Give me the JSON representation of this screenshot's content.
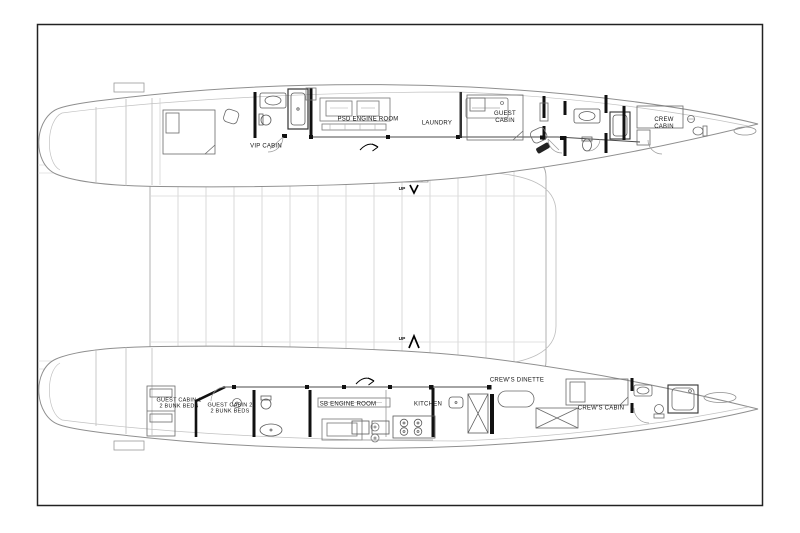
{
  "plan": {
    "port_hull": {
      "vip_cabin_label": "VIP CABIN",
      "engine_room_label": "PSD ENGINE ROOM",
      "laundry_label": "LAUNDRY",
      "guest_cabin_label_line1": "GUEST",
      "guest_cabin_label_line2": "CABIN",
      "crew_cabin_label_line1": "CREW",
      "crew_cabin_label_line2": "CABIN"
    },
    "starboard_hull": {
      "guest_cabin_1_label": "GUEST CABIN 1",
      "guest_cabin_1_sub": "2 BUNK BEDS",
      "guest_cabin_2_label": "GUEST CABIN 2",
      "guest_cabin_2_sub": "2 BUNK BEDS",
      "engine_room_label": "SB ENGINE ROOM",
      "kitchen_label": "KITCHEN",
      "crews_dinette_label": "CREW'S DINETTE",
      "crews_cabin_label": "CREW'S CABIN"
    },
    "stairs": {
      "up_forward_label": "UP",
      "up_aft_label": "UP"
    },
    "colors": {
      "hull_outline": "#8f8f8f",
      "grid_line": "#c9c9c9",
      "wall": "#101010",
      "fixture": "#5a5a5a",
      "label_text": "#141414",
      "background": "#ffffff"
    }
  }
}
